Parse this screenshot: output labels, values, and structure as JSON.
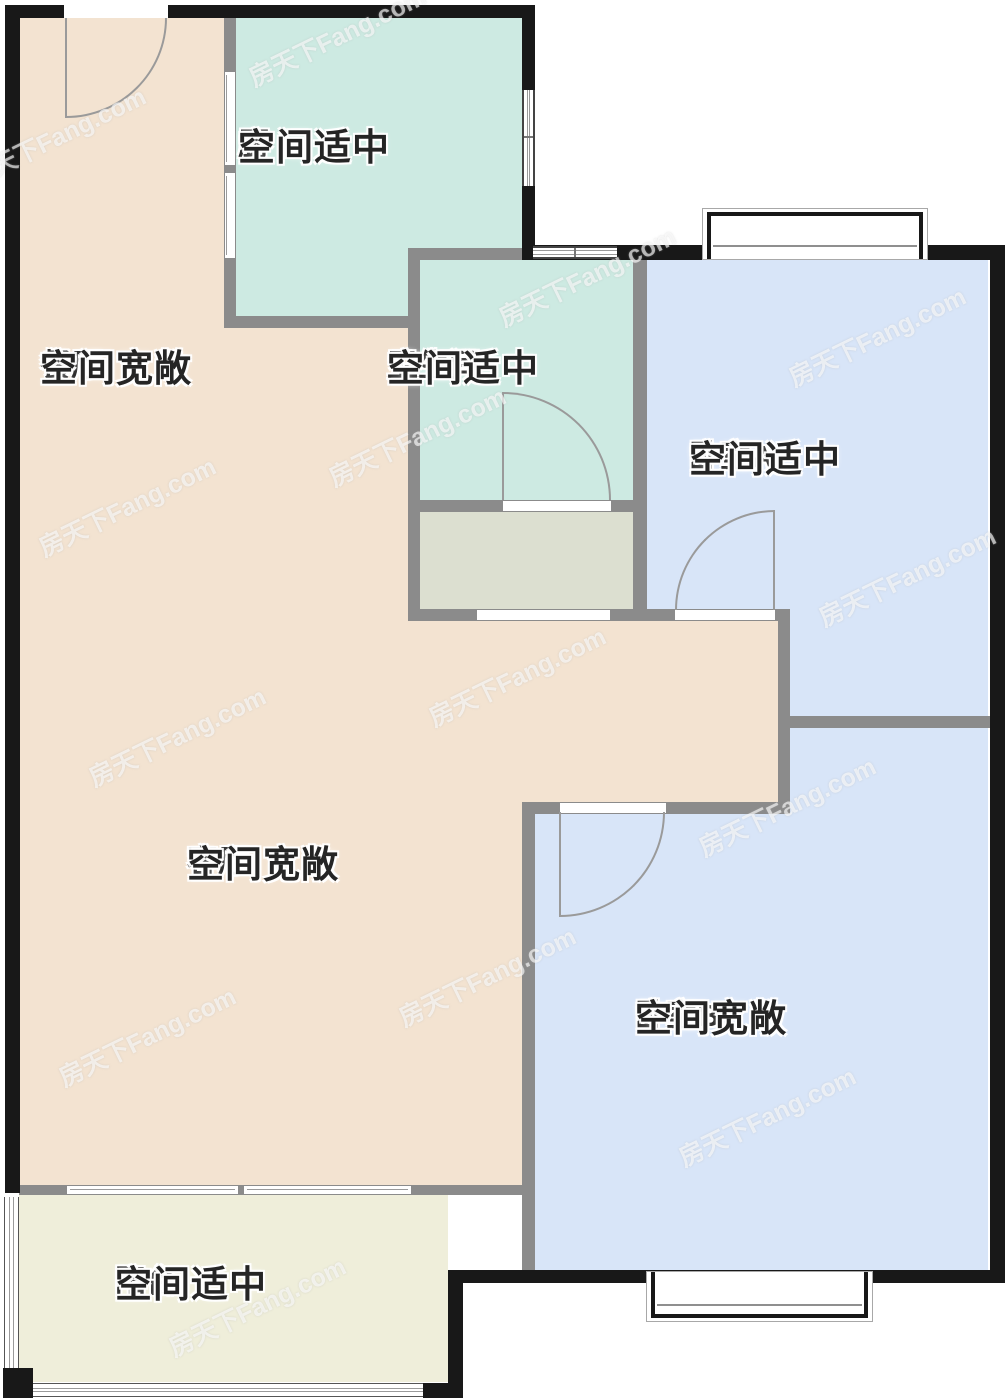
{
  "watermark": {
    "text": "房天下Fang.com"
  },
  "colors": {
    "interior_wall": "#8b8b8b",
    "exterior_wall": "#181818",
    "door_line": "#9a9a9a"
  },
  "rooms": {
    "kitchen": {
      "name": "厨",
      "note": "空间适中",
      "color": "#cdeae2"
    },
    "dining": {
      "name": "餐厅",
      "note": "空间宽敞",
      "color": "#f3e3d1"
    },
    "bathroom": {
      "name": "卫生间",
      "note": "空间适中",
      "color": "#cdeae2"
    },
    "bedroomA": {
      "name": "卧室A",
      "note": "空间适中",
      "color": "#d8e5f8"
    },
    "living": {
      "name": "客厅",
      "note": "空间宽敞",
      "color": "#f3e3d1"
    },
    "bedroomB": {
      "name": "卧室B",
      "note": "空间宽敞",
      "color": "#d8e5f8"
    },
    "balcony": {
      "name": "阳台",
      "note": "空间适中",
      "color": "#efeeda"
    },
    "utility": {
      "color": "#dcdfd0"
    }
  }
}
